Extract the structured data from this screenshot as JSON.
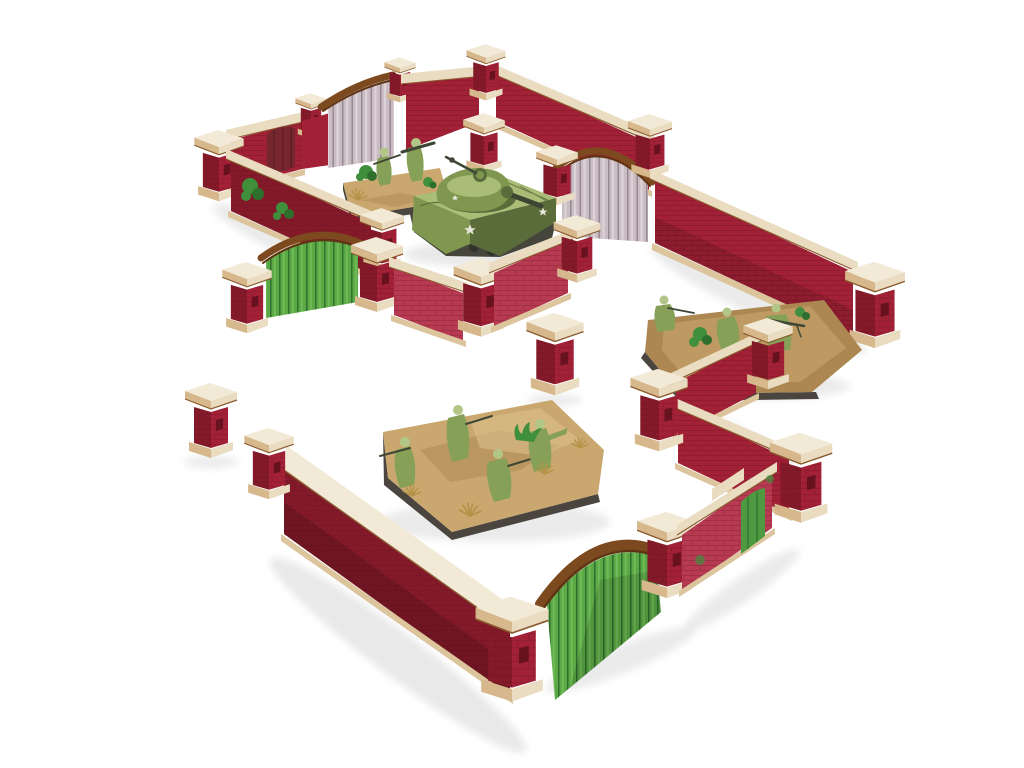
{
  "image": {
    "description": "Product photo of a tabletop wargaming brick-wall terrain set: dark red brick garden walls with cream stone coping and pillars, arched wooden gates, shown with an olive-green medium tank and three infantry stands on a white background",
    "background": "#ffffff"
  },
  "colors": {
    "background": "#ffffff",
    "brick": "#a32136",
    "brick_dark": "#841a29",
    "brick_pink": "#b83a52",
    "mortar": "#5a0f1a",
    "coping": "#e9dcc1",
    "coping_shade": "#d6b88c",
    "cap_top": "#f2e9d6",
    "foundation": "#dcc49c",
    "mdf_edge": "#8a5a2e",
    "gate_grey": "#c9bcc3",
    "gate_grey_streak": "#8f7c86",
    "gate_green": "#5aa945",
    "gate_green_dark": "#2b662b",
    "rail_brown": "#7c4a1e",
    "rail_brown_dark": "#5e3413",
    "door_red": "#76262e",
    "door_green": "#4d9a41",
    "tank_olive": "#7f974e",
    "tank_olive_light": "#a9bd76",
    "tank_olive_dark": "#5a6c3a",
    "track_grey": "#45453c",
    "gun_metal": "#3d4634",
    "star_white": "#e9e7dc",
    "base_tan": "#c9a76e",
    "base_tan_dark": "#ac8752",
    "base_rim": "#4a453e",
    "grass_dry": "#b39347",
    "grass_green": "#3f8f3c",
    "uniform_green": "#86a058",
    "uniform_light": "#b2c687",
    "shadow": "#d7d7d7"
  },
  "scene": {
    "terrain": {
      "wall_sections": 11,
      "attached_pillars": 18,
      "freestanding_pillars": 3,
      "grey_wood_gates": 2,
      "green_wood_gates": 2,
      "green_side_doors": 1,
      "red_side_doors": 1
    },
    "miniatures": {
      "tank_count": 1,
      "tank_label": "olive-green medium tank with white stars",
      "infantry_stands": [
        {
          "soldiers": 2,
          "label": "two-man team on desert base"
        },
        {
          "soldiers": 3,
          "label": "three-man weapons team behind wall"
        },
        {
          "soldiers": 4,
          "label": "four-man rifle squad on desert base"
        }
      ]
    }
  }
}
